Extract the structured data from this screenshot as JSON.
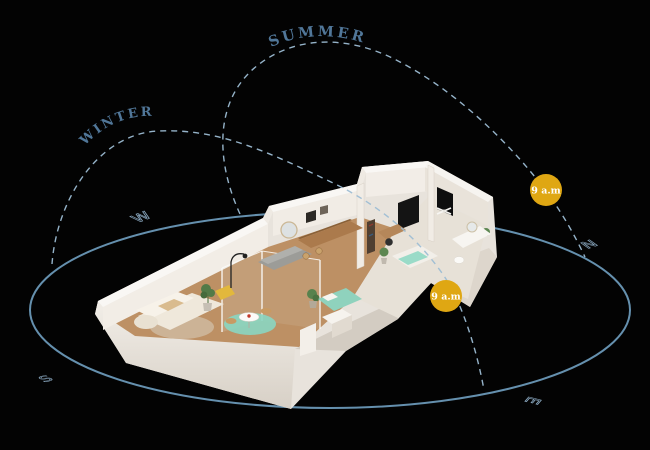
{
  "scene": {
    "background": "#030303"
  },
  "sun_paths": {
    "summer": {
      "label": "SUMMER",
      "marker": {
        "time": "9 a.m"
      }
    },
    "winter": {
      "label": "WINTER",
      "marker": {
        "time": "9 a.m"
      }
    }
  },
  "compass": {
    "west": "W",
    "north": "N",
    "south": "S",
    "east": "E"
  },
  "colors": {
    "sun_marker": "#DFA713",
    "path_line": "#9DBDD4",
    "ground_ring": "#6590AE",
    "label_text": "#517799",
    "compass": "#8AA8C0"
  }
}
